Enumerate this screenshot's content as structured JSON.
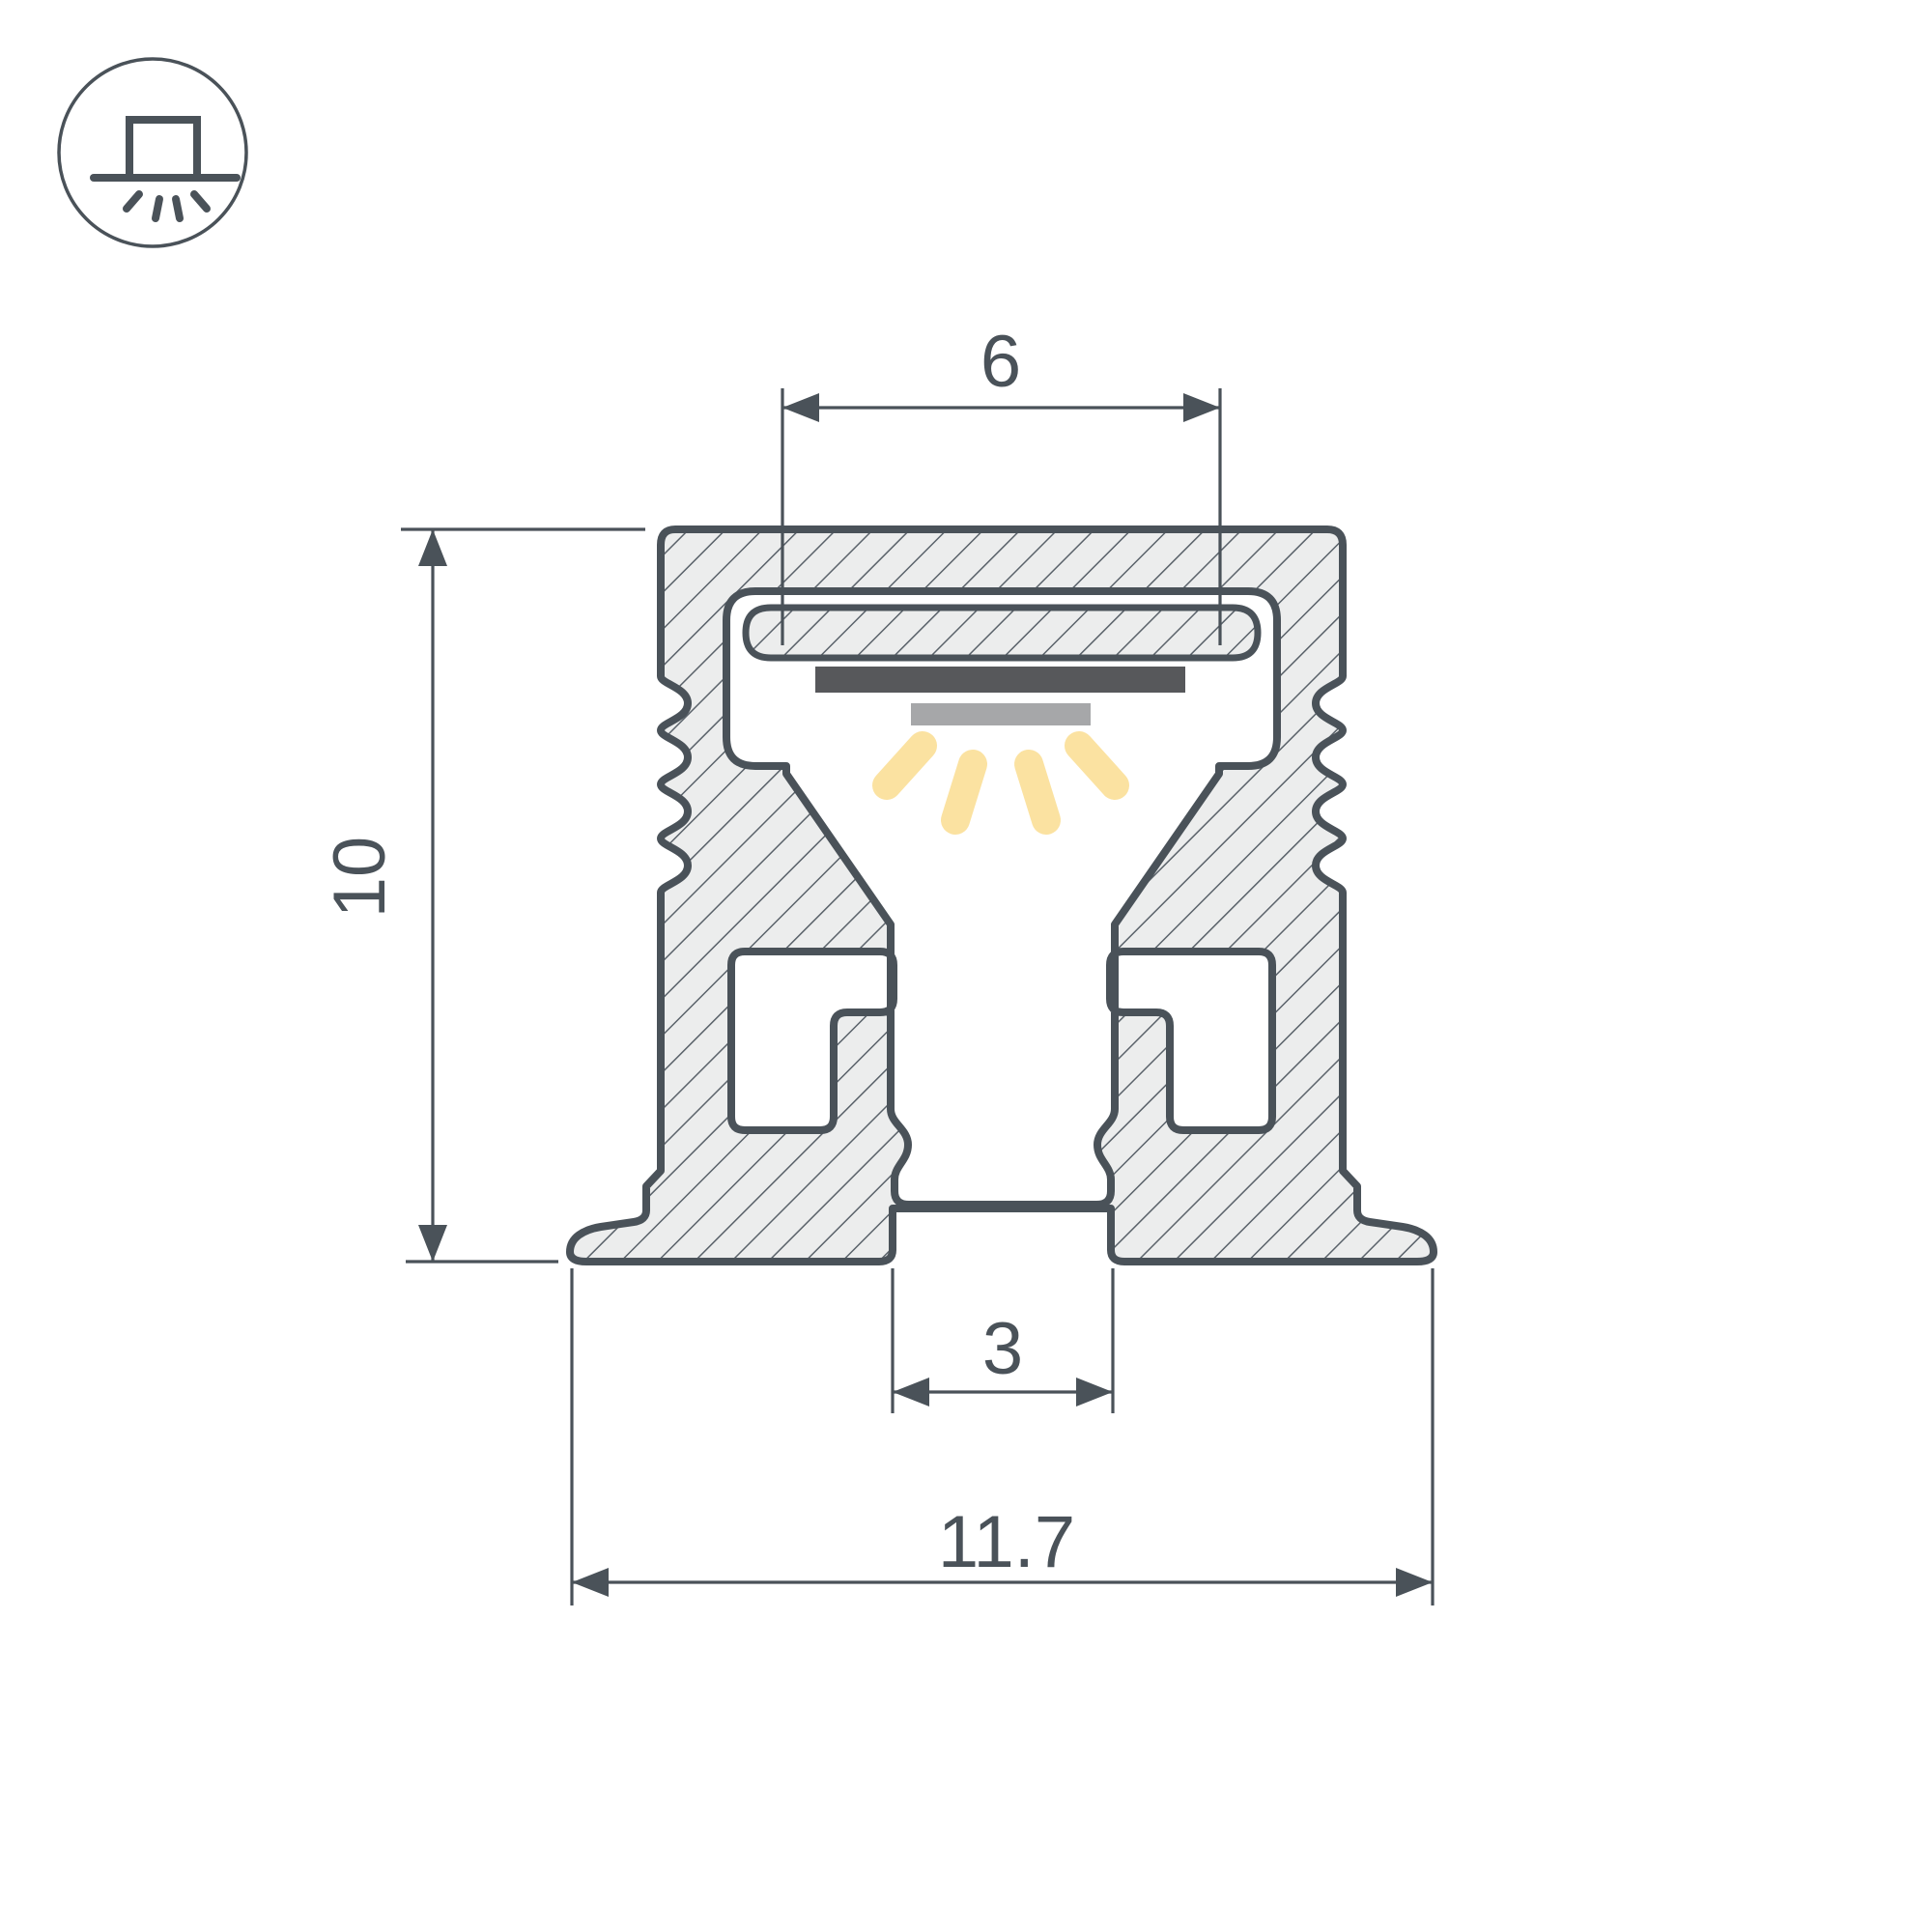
{
  "diagram": {
    "kind": "led-profile-cross-section-drawing",
    "dimensions": {
      "inner_slot_width": "6",
      "height": "10",
      "bottom_slot_width": "3",
      "overall_width": "11.7"
    },
    "icon": {
      "name": "surface-mounted-downlight-icon"
    },
    "colors": {
      "line": "#4A5259",
      "aluminum_fill": "#ECEDED",
      "hatch_line": "#5A626A",
      "led_pcb": "#57585B",
      "led_emitter": "#A6A7A9",
      "light_ray": "#FBE2A1",
      "background": "#FFFFFF"
    }
  }
}
